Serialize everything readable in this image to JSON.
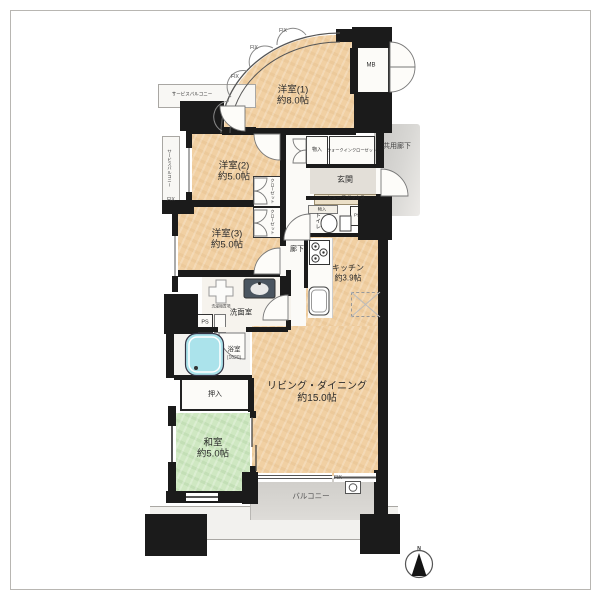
{
  "rooms": [
    {
      "name": "洋室(1)",
      "size": "約8.0帖"
    },
    {
      "name": "洋室(2)",
      "size": "約5.0帖"
    },
    {
      "name": "洋室(3)",
      "size": "約5.0帖"
    },
    {
      "name": "和室",
      "size": "約5.0帖"
    },
    {
      "name": "リビング・ダイニング",
      "size": "約15.0帖"
    },
    {
      "name": "キッチン",
      "size": "約3.9帖"
    }
  ],
  "labels": {
    "entrance": "玄関",
    "common_corridor": "共用廊下",
    "corridor": "廊下",
    "toilet": "トイレ",
    "washroom": "洗面室",
    "bathroom": "浴室",
    "bathroom_size": "(1620)",
    "oshiire": "押入",
    "storage": "物入",
    "walk_in_closet": "ウォークインクローゼット",
    "shoe_box": "シューズボックス",
    "closet": "クローゼット",
    "service_balcony": "サービスバルコニー",
    "balcony": "バルコニー",
    "meter_box": "MB",
    "pipe_space": "PS",
    "fix_window": "FIX",
    "washer_place": "洗濯機置場",
    "north": "N"
  },
  "colors": {
    "room_fill": "#f1d0a3",
    "tatami_fill": "#cfe8c2",
    "tub_fill": "#abe3eb",
    "wall": "#1b1b1b",
    "common_area_gray": "#d3d1cd",
    "balcony_gray": "#d7d5d1"
  }
}
